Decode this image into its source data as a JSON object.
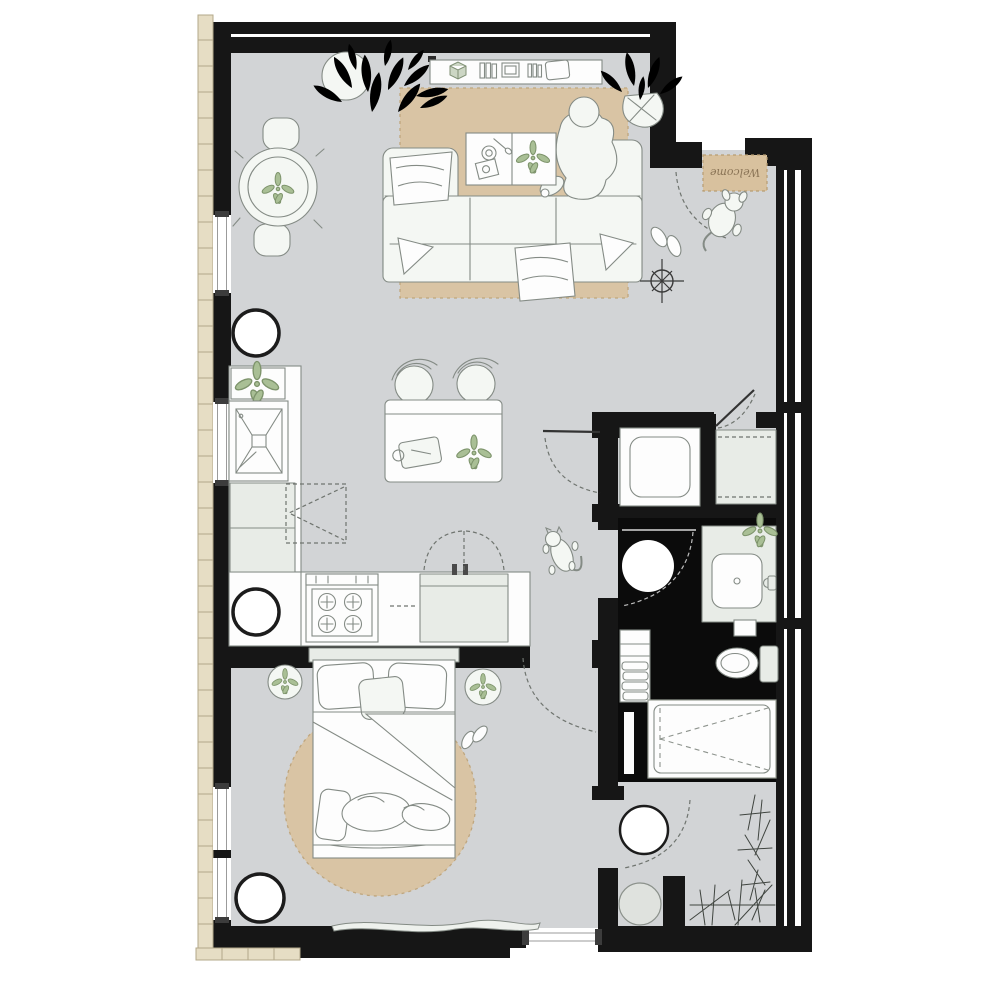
{
  "document": {
    "type": "apartment floor plan",
    "view": "top-down architectural drawing"
  },
  "entry": {
    "welcome_mat_label": "Welcome"
  },
  "colors": {
    "wall": "#161616",
    "floor": "#d2d4d6",
    "bathfloor": "#0b0b0b",
    "brick": "#e6ddc4",
    "brickline": "#b3a88a",
    "rug": "#d9c4a4",
    "rugline": "#bfa67e",
    "furn": "#f4f7f3",
    "line": "#848b85",
    "green": "#a9bf95",
    "greendark": "#7d936b",
    "mat": "#d8c19e",
    "mattext": "#8a7456"
  },
  "rooms": [
    {
      "name": "living-dining",
      "furniture": [
        "round-dining-table",
        "dining-chairs",
        "large-potted-plant",
        "sideboard-shelf",
        "u-shaped-sofa",
        "coffee-table",
        "area-rug",
        "round-floor-stool",
        "seated-person",
        "slippers",
        "ceiling-light-symbol",
        "entry-plant"
      ]
    },
    {
      "name": "kitchen",
      "furniture": [
        "kitchen-sink",
        "base-cabinets",
        "counter-plant",
        "cooktop-stove",
        "sink-cabinet",
        "extractor-hood-dashed",
        "bar-table",
        "bar-stools",
        "round-floor-stool"
      ]
    },
    {
      "name": "entry-hall",
      "furniture": [
        "welcome-mat",
        "dog",
        "door-swing-arc",
        "walking-cat"
      ]
    },
    {
      "name": "utility-closet",
      "furniture": [
        "washing-machine",
        "appliance-cabinet",
        "closet-doors"
      ]
    },
    {
      "name": "bathroom",
      "furniture": [
        "ceiling-light-disc",
        "vanity-sink",
        "toilet",
        "towel-shelf",
        "bathtub",
        "wall-niche"
      ]
    },
    {
      "name": "laundry-room",
      "furniture": [
        "round-fixture",
        "washer-drum-closet",
        "plant-sketches",
        "door-swing-arc"
      ]
    },
    {
      "name": "bedroom",
      "furniture": [
        "double-bed",
        "pillows",
        "pet-on-bed",
        "round-rug",
        "bedside-tables",
        "floor-pouf",
        "slippers",
        "doormat"
      ]
    }
  ],
  "structure": {
    "walls": "solid black poche",
    "exterior_finish": "brick strip on west and south-west",
    "windows": [
      "west-wall band of 4 windows",
      "south bedroom window"
    ],
    "doors": [
      "main-entrance-top-right",
      "closet-door",
      "bathroom-door",
      "bedroom-door",
      "laundry-door"
    ]
  }
}
